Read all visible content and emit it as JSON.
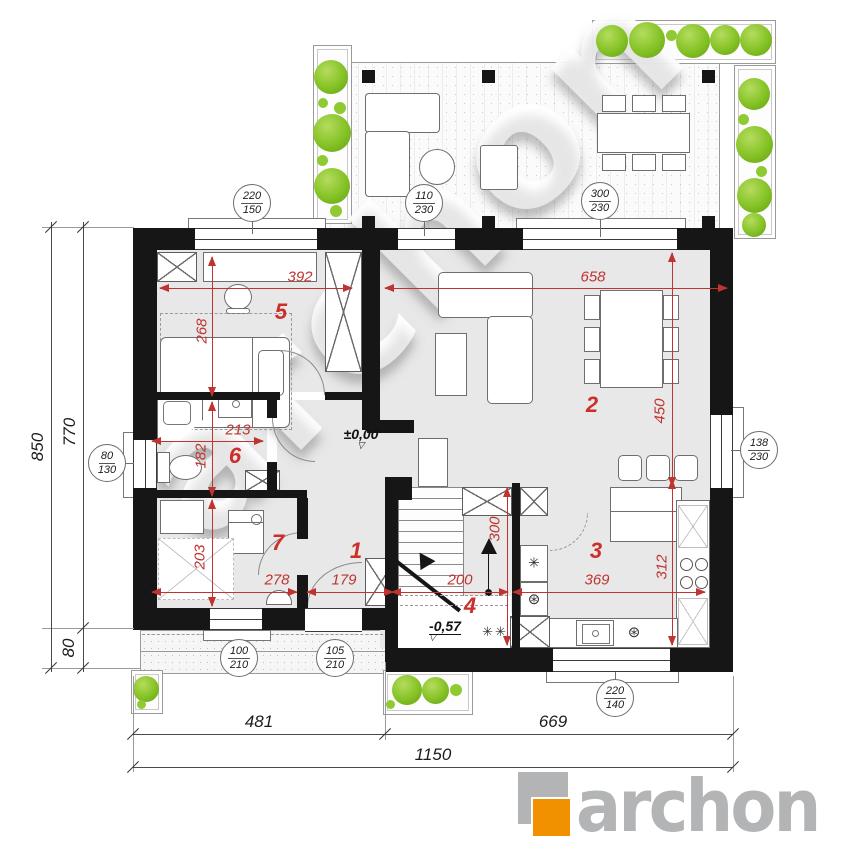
{
  "colors": {
    "wall": "#161616",
    "room_fill": "#e8e8e8",
    "dim_red": "#bf3430",
    "plant_green": "#84c225",
    "logo_gray": "#b2b4b5",
    "logo_orange": "#f29100"
  },
  "watermark": {
    "text": "archon"
  },
  "logo": {
    "brand": "archon"
  },
  "rooms": {
    "r1": "1",
    "r2": "2",
    "r3": "3",
    "r4": "4",
    "r5": "5",
    "r6": "6",
    "r7": "7"
  },
  "dims": {
    "d392": "392",
    "d658": "658",
    "d268": "268",
    "d213": "213",
    "d182": "182",
    "d203": "203",
    "d278": "278",
    "d179": "179",
    "d200": "200",
    "d369": "369",
    "d450": "450",
    "d312": "312",
    "d300": "300"
  },
  "ext": {
    "total_v": "850",
    "house_v": "770",
    "porch_v": "80",
    "bottom_left": "481",
    "bottom_right": "669",
    "total_h": "1150"
  },
  "levels": {
    "main": "±0,00",
    "entry": "-0,57"
  },
  "openings": {
    "bedroom_window": {
      "w": "220",
      "h": "150"
    },
    "terrace_door": {
      "w": "110",
      "h": "230"
    },
    "living_window": {
      "w": "300",
      "h": "230"
    },
    "bath_window": {
      "w": "80",
      "h": "130"
    },
    "utility_window": {
      "w": "100",
      "h": "210"
    },
    "entry_door": {
      "w": "105",
      "h": "210"
    },
    "dining_window": {
      "w": "138",
      "h": "230"
    },
    "kitchen_window": {
      "w": "220",
      "h": "140"
    }
  },
  "symbols": {
    "star": "✳",
    "double_star": "✳✳",
    "appliance": "⊛",
    "dishwasher": "⊛"
  }
}
